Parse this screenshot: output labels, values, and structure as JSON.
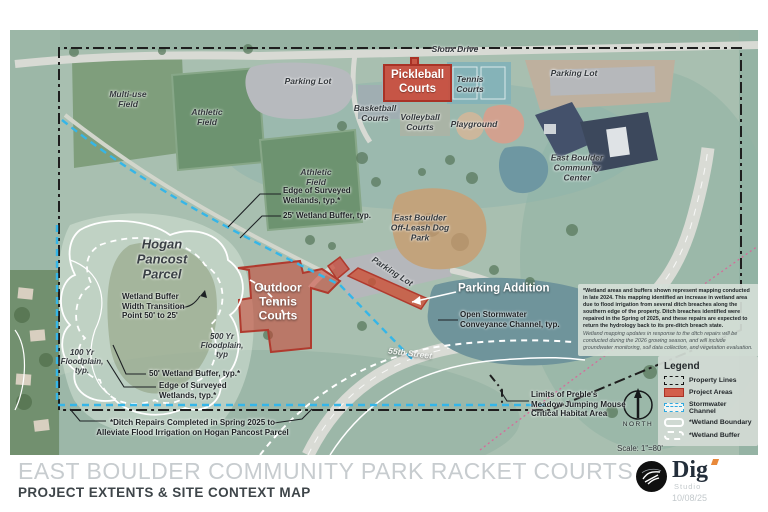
{
  "title": {
    "main": "EAST BOULDER COMMUNITY PARK RACKET COURTS",
    "sub": "PROJECT EXTENTS & SITE CONTEXT MAP",
    "date": "10/08/25",
    "logo_name": "Dig",
    "logo_sub": "Studio"
  },
  "map": {
    "labels": {
      "sioux_drive": "Sioux Drive",
      "parking_lot_nw": "Parking Lot",
      "parking_lot_ne": "Parking Lot",
      "parking_lot_center": "Parking Lot",
      "pickleball": "Pickleball\nCourts",
      "tennis_courts": "Tennis\nCourts",
      "basketball": "Basketball\nCourts",
      "volleyball": "Volleyball\nCourts",
      "playground": "Playground",
      "multiuse_field": "Multi-use\nField",
      "athletic_field_1": "Athletic\nField",
      "athletic_field_2": "Athletic\nField",
      "community_center": "East Boulder\nCommunity\nCenter",
      "dog_park": "East Boulder\nOff-Leash Dog\nPark",
      "hogan": "Hogan\nPancost\nParcel",
      "street_55": "55th Street",
      "outdoor_tennis": "Outdoor\nTennis\nCourts",
      "parking_addition": "Parking Addition"
    },
    "annotations": {
      "edge_wetlands_n": "Edge of Surveyed\nWetlands, typ.*",
      "buffer_25": "25' Wetland Buffer, typ.",
      "buffer_50": "50' Wetland Buffer, typ.*",
      "edge_wetlands_s": "Edge of Surveyed\nWetlands, typ.*",
      "transition": "Wetland Buffer\nWidth Transition\nPoint 50' to 25'",
      "floodplain_500": "500 Yr\nFloodplain,\ntyp",
      "floodplain_100": "100 Yr\nFloodplain,\ntyp.",
      "open_stormwater": "Open Stormwater\nConveyance Channel, typ.",
      "preble": "Limits of Preble's\nMeadow Jumping Mouse\nCritical Habitat Area",
      "ditch_note": "*Ditch Repairs Completed in Spring 2025 to\nAlleviate Flood Irrigation on Hogan Pancost Parcel"
    },
    "notes": {
      "wetland_bold": "*Wetland areas and buffers shown represent mapping conducted in late 2024. This mapping identified an increase in wetland area due to flood irrigation from several ditch breaches along the southern edge of the property. Ditch breaches identified were repaired in the Spring of 2025, and these repairs are expected to return the hydrology back to its pre-ditch breach state.",
      "wetland_italic": "Wetland mapping updates in response to the ditch repairs will be conducted during the 2026 growing season, and will include groundwater monitoring, soil data collection, and vegetation evaluation."
    },
    "legend": {
      "title": "Legend",
      "items": [
        {
          "label": "Property Lines"
        },
        {
          "label": "Project Areas"
        },
        {
          "label": "Stormwater Channel"
        },
        {
          "label": "*Wetland Boundary"
        },
        {
          "label": "*Wetland Buffer"
        }
      ]
    },
    "north_label": "NORTH",
    "scale": "Scale: 1\"=80'"
  },
  "colors": {
    "project_red": "#CA4A3A",
    "stormwater_blue": "#35B6E8",
    "property_line": "#1E1E1E",
    "wetland_white": "#FFFFFF"
  }
}
